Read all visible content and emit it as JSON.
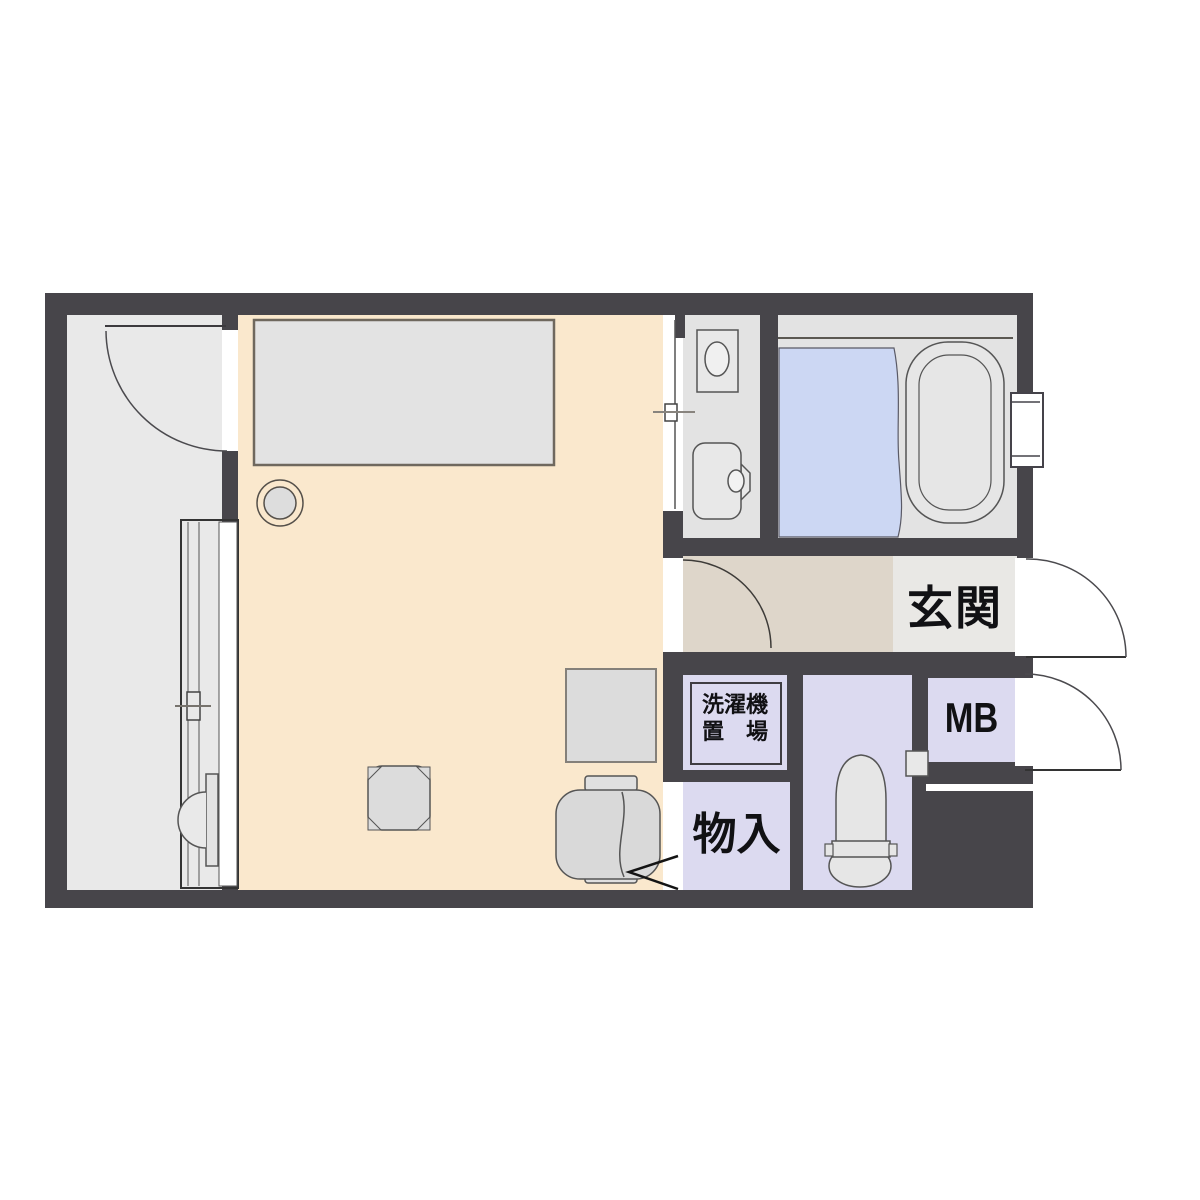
{
  "plan": {
    "title_hint": "one-room apartment floor plan",
    "labels": {
      "genkan": "玄関",
      "mb": "MB",
      "monoire": "物入",
      "laundry_line1": "洗濯機",
      "laundry_line2": "置　場"
    },
    "rooms": [
      "balcony",
      "main-room",
      "washroom",
      "bathroom",
      "hall",
      "entrance",
      "laundry-space",
      "storage",
      "toilet-room",
      "meter-box"
    ],
    "fixtures": [
      "bed",
      "stool",
      "desk",
      "office-chair",
      "low-table",
      "toilet",
      "bathtub",
      "shower-area",
      "wash-basin",
      "mirror-cabinet",
      "air-conditioner-unit",
      "sliding-window",
      "sliding-door",
      "hinged-door"
    ],
    "colors": {
      "wall": "#47454a",
      "main_room_floor": "#fae8cd",
      "balcony_floor": "#e9e9e9",
      "wet_area_floor": "#e3e3e3",
      "hall_floor": "#ded6ca",
      "entrance_floor": "#e9e8e5",
      "service_floor": "#dcdaf0",
      "bath_wet_floor": "#ccd7f3",
      "fixture_fill": "#e3e3e3",
      "outline": "#4b4b4b",
      "label_text": "#111114"
    }
  }
}
